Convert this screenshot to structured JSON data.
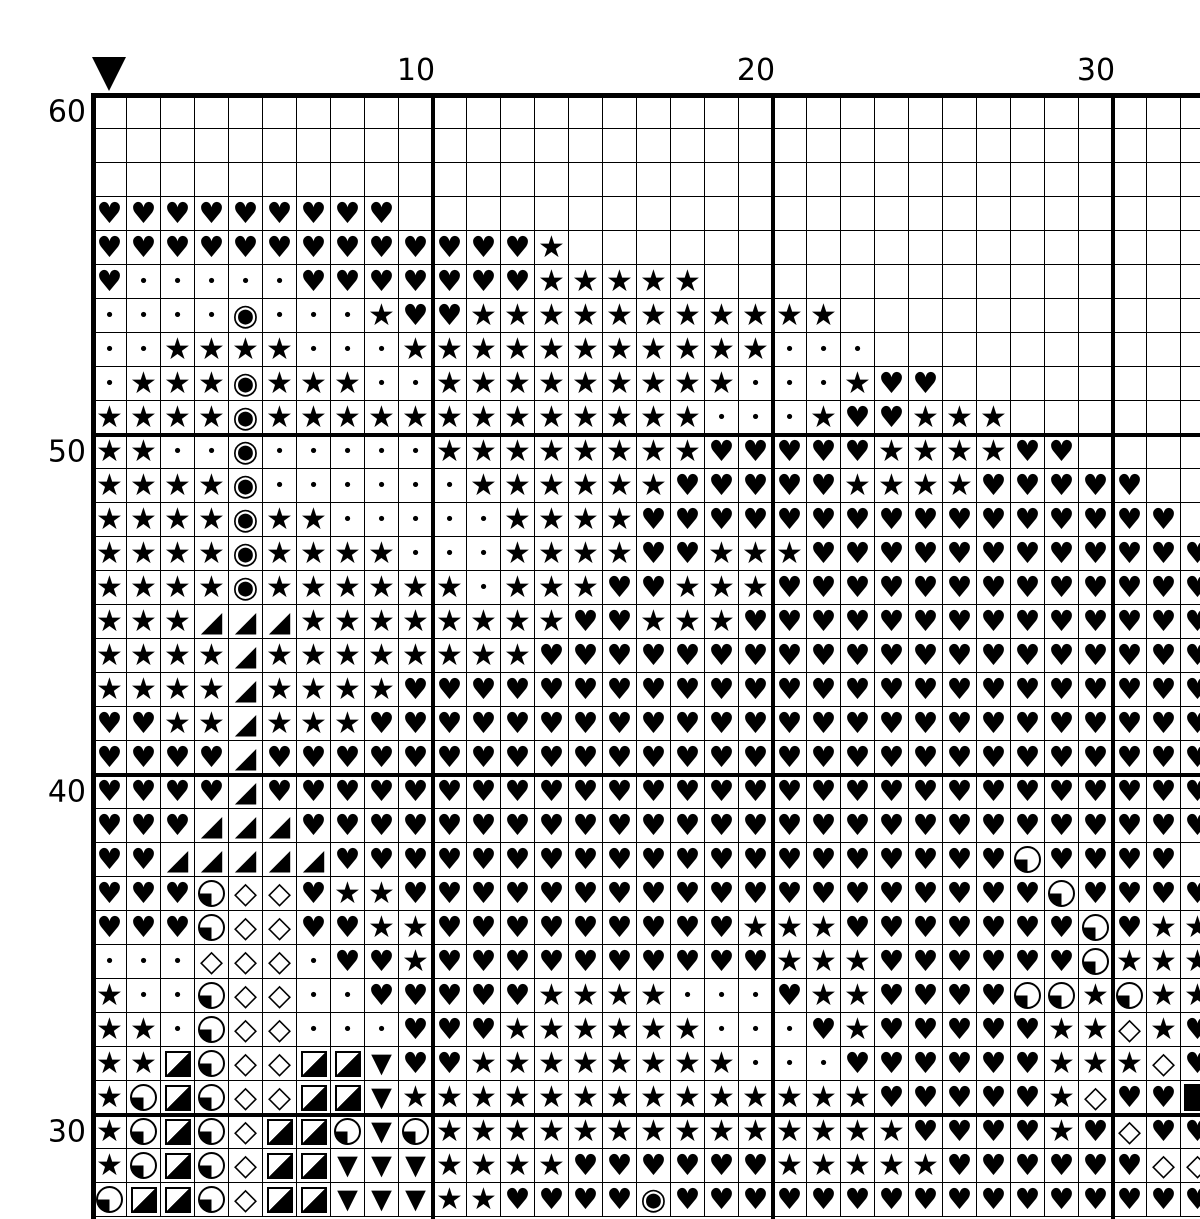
{
  "colors": {
    "ink": "#000000",
    "background": "#ffffff"
  },
  "marker": {
    "name": "pattern-center",
    "col": 1
  },
  "chart_data": {
    "type": "heatmap",
    "title": "",
    "description": "Cross-stitch pattern grid; each cell holds a stitch symbol. Bold lines every 10 cells.",
    "grid_on": true,
    "visible_rows": 33,
    "visible_cols": 33,
    "row_labels": [
      {
        "row": 1,
        "label": "60"
      },
      {
        "row": 11,
        "label": "50"
      },
      {
        "row": 21,
        "label": "40"
      },
      {
        "row": 31,
        "label": "30"
      }
    ],
    "col_labels": [
      {
        "col": 10,
        "label": "10"
      },
      {
        "col": 20,
        "label": "20"
      },
      {
        "col": 30,
        "label": "30"
      }
    ],
    "legend": {
      "H": {
        "name": "heart",
        "glyph": "♥"
      },
      "S": {
        "name": "star",
        "glyph": "★"
      },
      "d": {
        "name": "dot",
        "glyph": "•"
      },
      "E": {
        "name": "circled-dot",
        "glyph": "◉"
      },
      "T": {
        "name": "corner-triangle",
        "glyph": "◢"
      },
      "D": {
        "name": "diamond",
        "glyph": "◇"
      },
      "V": {
        "name": "down-triangle",
        "glyph": "▼"
      },
      "Q": {
        "name": "quarter-circle",
        "shape": true
      },
      "R": {
        "name": "half-square",
        "shape": true
      },
      "B": {
        "name": "filled-square",
        "shape": true
      }
    },
    "rows": [
      "_________________________________",
      "_________________________________",
      "_________________________________",
      "HHHHHHHHH________________________",
      "HHHHHHHHHHHHHS___________________",
      "HdddddHHHHHHHSSSSS_______________",
      "ddddEdddSHHSSSSSSSSSSS___________",
      "ddSSSSdddSSSSSSSSSSSddd__________",
      "dSSSESSSddSSSSSSSSSdddSHH________",
      "SSSSESSSSSSSSSSSSSdddSHHSSS______",
      "SSddEdddddSSSSSSSSHHHHHSSSSHH____",
      "SSSSEddddddSSSSSSHHHHHSSSSHHHHH__",
      "SSSSESSdddddSSSSHHHHHHHHHHHHHHHH_",
      "SSSSESSSSdddSSSSHHSSSHHHHHHHHHHHH",
      "SSSSESSSSSSdSSSHHSSSHHHHHHHHHHHHH",
      "SSSTTTSSSSSSSSHHSSSHHHHHHHHHHHHHH",
      "SSSSTSSSSSSSSHHHHHHHHHHHHHHHHHHHH",
      "SSSSTSSSSHHHHHHHHHHHHHHHHHHHHHHHH",
      "HHSSTSSSHHHHHHHHHHHHHHHHHHHHHHHHH",
      "HHHHTHHHHHHHHHHHHHHHHHHHHHHHHHHHH",
      "HHHHTHHHHHHHHHHHHHHHHHHHHHHHHHHHH",
      "HHHTTTHHHHHHHHHHHHHHHHHHHHHHHHHHH",
      "HHTTTTTHHHHHHHHHHHHHHHHHHHHQHHHH",
      "HHHQDDHSSHHHHHHHHHHHHHHHHHHHQHHHH",
      "HHHQDDHHSSHHHHHHHHHSSSHHHHHHHQHSS",
      "dddDDDdHHSHHHHHHHHHHSSSHHHHHHQSSS",
      "SddQDDddHHHHHSSSSdddHSSHHHHQQSQSS",
      "SSdQDDdddHHHSSSSSSdddHSHHHHHSSDSH",
      "SSRQDDRRVHHSSSSSSSSdddHHHHHHSSSDH",
      "SQRQDDRRVSSSSSSSSSSSSSSHHHHHSDHHB",
      "SQRQDRRQVQSSSSSSSSSSSSSSHHHHSHDHH",
      "SQRQDRRVVVSSSSHHHHHHSSSSSHHHHHHDD",
      "QRRQDRRVVVSSHHHHEHHHHHHHHHHHHHHHH"
    ]
  }
}
